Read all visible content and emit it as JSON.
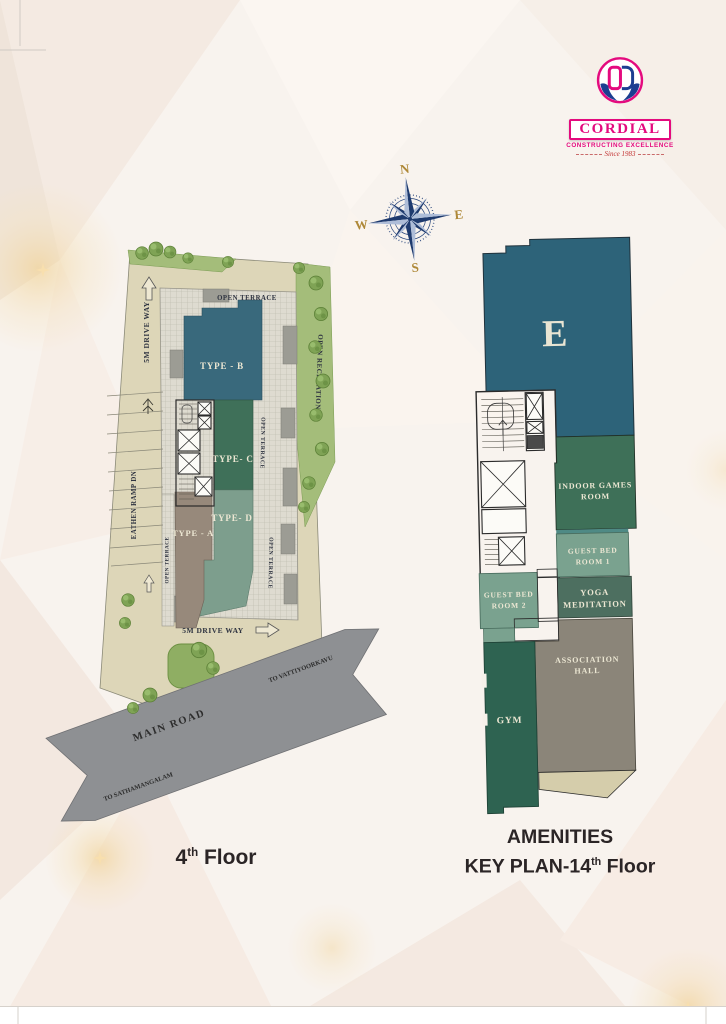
{
  "page": {
    "bg_color": "#f8f3ee",
    "left_caption": {
      "number": "4",
      "sup": "th",
      "text": " Floor"
    },
    "right_caption": {
      "line1": "AMENITIES",
      "line2": "KEY PLAN-14",
      "sup": "th",
      "text": " Floor"
    }
  },
  "logo": {
    "name": "CORDIAL",
    "tagline": "CONSTRUCTING EXCELLENCE",
    "since": "Since 1983",
    "pink": "#e40a7e",
    "blue": "#1c3e91"
  },
  "compass": {
    "n": "N",
    "e": "E",
    "s": "S",
    "w": "W",
    "star_dark": "#1e3a6e",
    "star_light": "#aebdd8",
    "letters": "#ae8837"
  },
  "palette": {
    "plot": "#ddd6b8",
    "grid": "#dedbd0",
    "road": "#8e9093",
    "landscape": "#a4bd7a",
    "tree": "#7fa355",
    "type_b": "#39697c",
    "type_c": "#3f7059",
    "type_d": "#7d9e8d",
    "type_a": "#97897b",
    "e_block": "#2d6379",
    "indoor_games": "#3e7058",
    "guest": "#7aa28f",
    "guest_strip": "#4f8a85",
    "yoga": "#4d6f60",
    "gym": "#2e6351",
    "hall": "#8b8579",
    "wedge": "#d5cdab"
  },
  "left_plan": {
    "type_b": "TYPE - B",
    "type_c": "TYPE- C",
    "type_d": "TYPE- D",
    "type_a": "TYPE - A",
    "open_terrace_top": "OPEN TERRACE",
    "open_terrace_left": "OPEN TERRACE",
    "open_terrace_r1": "OPEN TERRACE",
    "open_terrace_r2": "OPEN TERRACE",
    "open_recreation": "OPEN RECREATION",
    "drive_way_left": "5M DRIVE WAY",
    "drive_way_bottom": "5M DRIVE WAY",
    "ramp": "EATHEN RAMP DN",
    "road_name": "MAIN ROAD",
    "to_left": "TO SATHAMANGALAM",
    "to_right": "TO VATTIYOORKAVU"
  },
  "right_plan": {
    "tower": "E",
    "indoor_games_1": "INDOOR GAMES",
    "indoor_games_2": "ROOM",
    "guest1_1": "GUEST BED",
    "guest1_2": "ROOM 1",
    "yoga_1": "YOGA",
    "yoga_2": "MEDITATION",
    "guest2_1": "GUEST BED",
    "guest2_2": "ROOM 2",
    "gym": "GYM",
    "hall_1": "ASSOCIATION",
    "hall_2": "HALL"
  }
}
